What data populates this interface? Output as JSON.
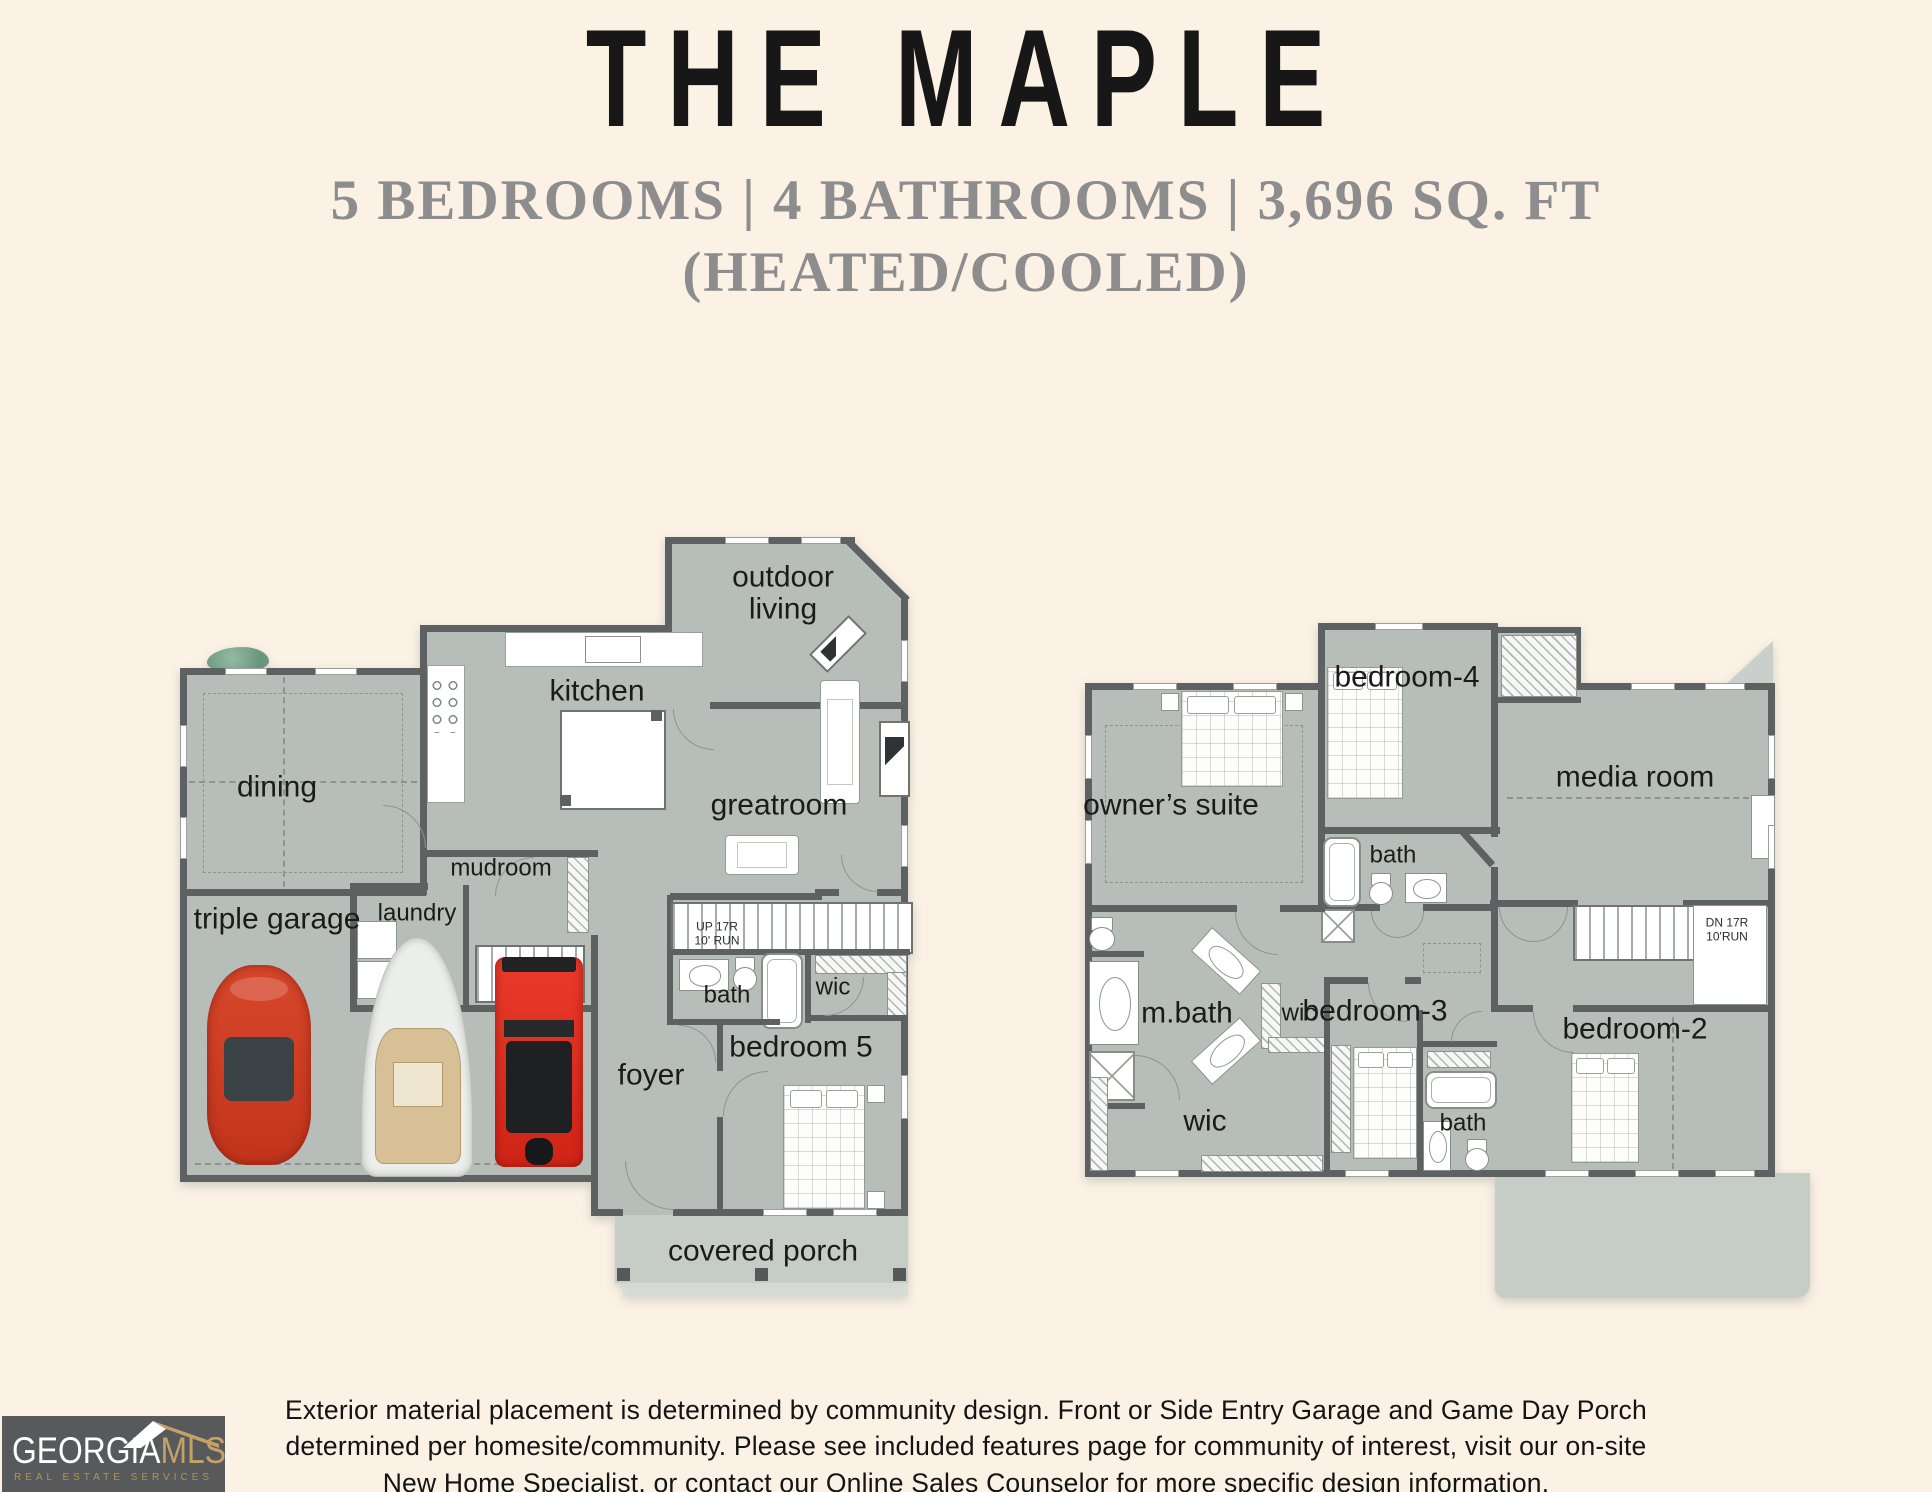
{
  "header": {
    "title": "THE MAPLE",
    "subtitle_line1": "5 BEDROOMS | 4 BATHROOMS | 3,696 SQ. FT",
    "subtitle_line2": "(HEATED/COOLED)"
  },
  "floor1": {
    "outdoor_living": "outdoor living",
    "kitchen": "kitchen",
    "dining": "dining",
    "greatroom": "greatroom",
    "mudroom": "mudroom",
    "laundry": "laundry",
    "garage": "triple garage",
    "bath": "bath",
    "wic": "wic",
    "bedroom5": "bedroom 5",
    "foyer": "foyer",
    "porch": "covered porch",
    "stairs": {
      "line1": "UP 17R",
      "line2": "10' RUN"
    }
  },
  "floor2": {
    "owners_suite": "owner’s suite",
    "bedroom4": "bedroom-4",
    "media_room": "media room",
    "bath_upper": "bath",
    "mbath": "m.bath",
    "wic_mid": "wic",
    "bedroom3": "bedroom-3",
    "bedroom2": "bedroom-2",
    "wic_lower": "wic",
    "bath_lower": "bath",
    "stairs": {
      "line1": "DN 17R",
      "line2": "10'RUN"
    }
  },
  "footer": {
    "lines": [
      "Exterior material placement is determined by community design. Front or Side Entry Garage and Game Day Porch",
      "determined per homesite/community. Please see included features page for community of interest, visit our on-site",
      "New Home Specialist, or contact our Online Sales Counselor for more specific design information."
    ]
  },
  "logo": {
    "brand": "GEORGIA",
    "brand_accent": "MLS",
    "tagline": "REAL ESTATE SERVICES"
  },
  "colors": {
    "background": "#fbf2e5",
    "plan_floor": "#b7beba",
    "plan_wall": "#5d6161",
    "porch_floor": "#c6cdc7",
    "title_text": "#171717",
    "subtitle_text": "#8d8d8d",
    "vehicle_red": "#d8472b",
    "logo_gold": "#c3a269",
    "logo_background": "#58595b"
  }
}
